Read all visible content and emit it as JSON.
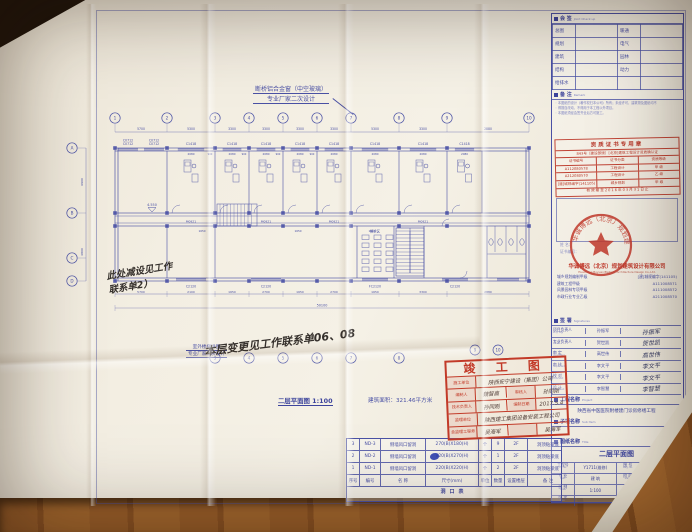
{
  "colors": {
    "ink_blue": "#4a51a5",
    "stamp_red": "#c23a28",
    "paper": "#f3eee2",
    "wood": "#9a5f2b"
  },
  "notes": {
    "window_note_l1": "断桥铝合金窗（中空玻璃）",
    "window_note_l2": "专业厂家二次设计",
    "stair_note_l1": "室外楼梯详图",
    "stair_note_l2": "专业厂家二次设计",
    "hand_left_l1": "此处减设见工作",
    "hand_left_l2": "联系单2）",
    "hand_center": "本层变更见工作联系单06、08",
    "plan_title": "二层平面图 1:100",
    "area_text": "建筑面积：321.46平方米"
  },
  "plan": {
    "overall_dim": "50100",
    "grid_top": [
      "1",
      "2",
      "3",
      "4",
      "5",
      "6",
      "7",
      "8",
      "9",
      "10"
    ],
    "grid_left": [
      "A",
      "B",
      "C",
      "D"
    ],
    "dims_top": [
      "5700",
      "5300",
      "3300",
      "3300",
      "3300",
      "3300",
      "5300",
      "3300",
      "2880"
    ],
    "dims_bottom": [
      "5700",
      "2100",
      "1650",
      "2700",
      "1650",
      "2700",
      "1650",
      "3300",
      "2880"
    ],
    "dims_left": [
      "6900",
      "4800"
    ],
    "porch_window": "C0712",
    "room_window": "C1418",
    "window_bottom": [
      "C2120",
      "C2120",
      "FC2120",
      "C2120"
    ],
    "door_label": "M0921",
    "dim_room": "2080",
    "dim_pier": "900",
    "dim_door": "1650",
    "level": "4.550",
    "waiting_label": "候诊区"
  },
  "titleblock": {
    "joint": {
      "title": "会 签",
      "en": "Joint Check up",
      "rows": [
        [
          "总图",
          "",
          "暖通",
          ""
        ],
        [
          "规划",
          "",
          "电气",
          ""
        ],
        [
          "建筑",
          "",
          "园林",
          ""
        ],
        [
          "结构",
          "",
          "动力",
          ""
        ],
        [
          "给排水",
          "",
          "",
          ""
        ]
      ]
    },
    "remark": {
      "title": "备 注",
      "en": "Remark",
      "lines": [
        "本图纸的设计（著作权归本公司）所有；未经许可，建筑物及图纸均不",
        "得擅自改动，不得用于本工程以外项目。",
        "本图纸须经会签齐全后方可施工。"
      ]
    },
    "license": {
      "title": "资质证书专用章",
      "subtitle": "843号（建设部颁）[北京]建筑工程设计资质确认证",
      "header": [
        "证书编号",
        "证书分类",
        "资质等级"
      ],
      "rows": [
        [
          "A112080578",
          "工程设计",
          "甲 级"
        ],
        [
          "A212080570",
          "工程设计",
          "乙 级"
        ],
        [
          "[建]城规编字(141105)",
          "城乡规划",
          "甲 级"
        ]
      ],
      "footer": "有效期至2016年03月31日止"
    },
    "registry": {
      "lines": [
        "姓 名：",
        "证书编号："
      ]
    },
    "company": {
      "cn": "华诚博远（北京）规划建筑设计有限公司",
      "en": "Huacheng Boyuan(BeiJing) Architecture Design Co.,Ltd.",
      "quals": [
        [
          "城乡规划编制甲级",
          "[建]城规编字(141105)"
        ],
        [
          "建筑工程甲级",
          "A111008571"
        ],
        [
          "风景园林专项甲级",
          "A111008572"
        ],
        [
          "市政行业专业乙级",
          "A211008570"
        ]
      ]
    },
    "signatures": {
      "title": "签 署",
      "en": "Signatures",
      "rows": [
        [
          "项目负责人",
          "Proj. Mgr",
          "孙振军"
        ],
        [
          "专业负责人",
          "Chief",
          "贺世凯"
        ],
        [
          "审 定",
          "Approved",
          "高世伟"
        ],
        [
          "审 核",
          "Inspected",
          "李文平"
        ],
        [
          "校 对",
          "Checked",
          "李文平"
        ],
        [
          "设 计",
          "Designed",
          "李智慧"
        ]
      ]
    },
    "project": {
      "title": "工程名称",
      "en": "Project",
      "value": "陕西省中医医院附楼建门诊房修缮工程"
    },
    "subitem": {
      "title": "子项名称",
      "en": "Sub Item",
      "value": ""
    },
    "sheet": {
      "title": "图纸名称",
      "en": "Title",
      "value": "二层平面图"
    },
    "info": {
      "rows": [
        {
          "l1": "工程号",
          "e1": "Prj. No.",
          "v1": "Y1711(维修)",
          "l2": "图 号",
          "e2": "Dwg. No.",
          "v2": "205"
        },
        {
          "l1": "专 业",
          "e1": "Spec.",
          "v1": "建 筑",
          "l2": "阶 段",
          "e2": "Stage",
          "v2": "方案报建"
        },
        {
          "l1": "比 例",
          "e1": "Scale",
          "v1": "1:100",
          "l2": "日 期",
          "e2": "Date",
          "v2": "16 年 2 月"
        },
        {
          "l1": "版 次",
          "e1": "Rev.",
          "v1": "",
          "l2": "备 注",
          "e2": "Remark",
          "v2": ""
        }
      ]
    }
  },
  "asbuilt": {
    "title": "竣 工 图",
    "rows": [
      [
        {
          "t": "l",
          "x": "施工单位",
          "w": 26
        },
        {
          "t": "v",
          "x": "陕西安宁建设（集团）公司",
          "w": 88
        }
      ],
      [
        {
          "t": "l",
          "x": "编制人",
          "w": 26
        },
        {
          "t": "v",
          "x": "魏智高",
          "w": 31
        },
        {
          "t": "l",
          "x": "审核人",
          "w": 26
        },
        {
          "t": "v",
          "x": "孙同刚",
          "w": 31
        }
      ],
      [
        {
          "t": "l",
          "x": "技术负责人",
          "w": 26
        },
        {
          "t": "v",
          "x": "孙同刚",
          "w": 31
        },
        {
          "t": "l",
          "x": "编制日期",
          "w": 26
        },
        {
          "t": "v",
          "x": "2017.5.4",
          "w": 31
        }
      ],
      [
        {
          "t": "l",
          "x": "监理单位",
          "w": 26
        },
        {
          "t": "v",
          "x": "陕西建工集团设备安装工程公司",
          "w": 88
        }
      ],
      [
        {
          "t": "l",
          "x": "总监理工程师",
          "w": 26
        },
        {
          "t": "v",
          "x": "吴海军",
          "w": 31
        },
        {
          "t": "l",
          "x": "",
          "w": 26
        },
        {
          "t": "v",
          "x": "吴海军",
          "w": 31
        }
      ]
    ]
  },
  "holes": {
    "title": "洞口表",
    "header": [
      "序号",
      "编号",
      "名 称",
      "尺寸(mm)",
      "单位",
      "数量",
      "设置楼层",
      "备 注"
    ],
    "col_w": [
      12,
      20,
      44,
      52,
      12,
      12,
      22,
      40
    ],
    "rows": [
      [
        "3",
        "ND-3",
        "侧墙风口留洞",
        "270(B)X180(H)",
        "个",
        "9",
        "2F",
        "洞顶贴梁底"
      ],
      [
        "2",
        "ND-2",
        "侧墙风口留洞",
        "820(B)X270(H)",
        "个",
        "1",
        "2F",
        "洞顶贴梁底"
      ],
      [
        "1",
        "ND-1",
        "侧墙风口留洞",
        "220(B)X220(H)",
        "个",
        "2",
        "2F",
        "洞顶贴梁底"
      ]
    ]
  }
}
